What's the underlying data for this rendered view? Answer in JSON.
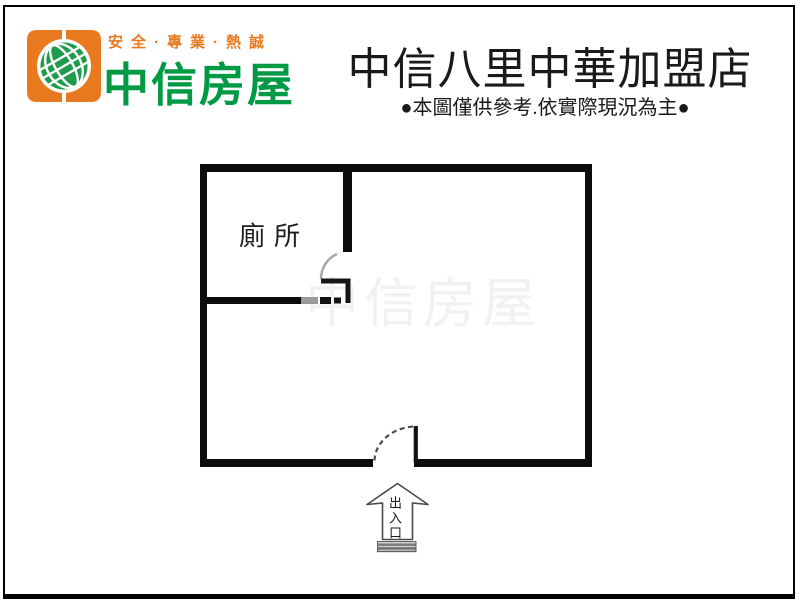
{
  "logo": {
    "tagline": "安全·專業·熱誠",
    "brand_name": "中信房屋"
  },
  "header": {
    "store_title": "中信八里中華加盟店",
    "disclaimer": "●本圖僅供參考.依實際現況為主●"
  },
  "floorplan": {
    "toilet_label": "廁所",
    "entrance_label": "出入口",
    "watermark": "中信房屋"
  },
  "colors": {
    "brand_orange": "#E8791F",
    "brand_green": "#009A44",
    "wall_black": "#0C0C0C"
  }
}
